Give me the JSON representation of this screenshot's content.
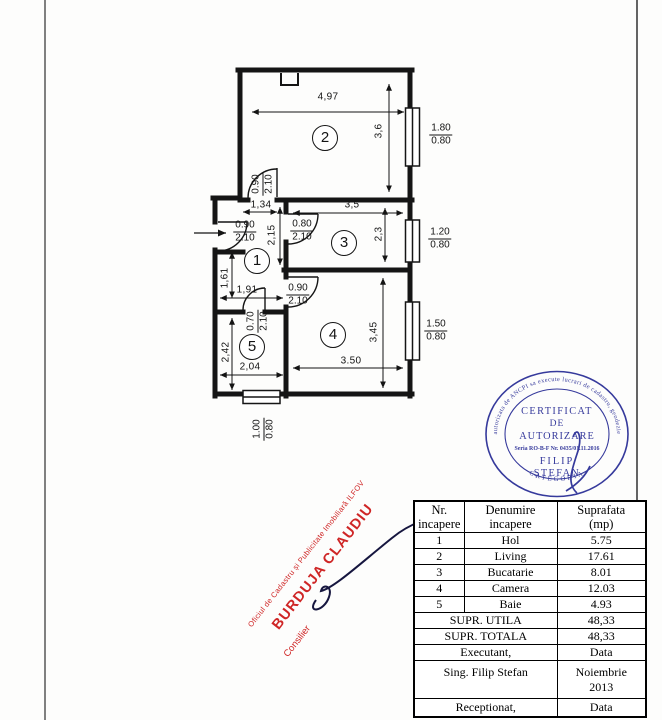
{
  "floorplan": {
    "rooms": {
      "r1": "1",
      "r2": "2",
      "r3": "3",
      "r4": "4",
      "r5": "5"
    },
    "dims": {
      "living_w": "4,97",
      "living_h": "3,6",
      "kitchen_w": "3,5",
      "kitchen_h": "2,3",
      "hall_door_w": "1,34",
      "hall_h1": "2,15",
      "hall_h2": "1,61",
      "hall_w": "1,91",
      "bath_h": "2,42",
      "bath_w": "2,04",
      "camera_h": "3,45",
      "camera_w": "3.50"
    },
    "openings": {
      "door_living": {
        "top": "0.90",
        "bottom": "2.10"
      },
      "door_entry": {
        "top": "0.90",
        "bottom": "2.10"
      },
      "door_kitchen": {
        "top": "0.80",
        "bottom": "2.10"
      },
      "door_camera": {
        "top": "0.90",
        "bottom": "2.10"
      },
      "door_bath": {
        "top": "0.70",
        "bottom": "2.10"
      },
      "win_living": {
        "top": "1.80",
        "bottom": "0.80"
      },
      "win_kitchen": {
        "top": "1.20",
        "bottom": "0.80"
      },
      "win_camera": {
        "top": "1.50",
        "bottom": "0.80"
      },
      "win_bath": {
        "top": "1.00",
        "bottom": "0.80"
      }
    }
  },
  "stamp_round": {
    "color": "#363a9c",
    "arc_top": "autorizata de ANCPI sa execute lucrari de cadastru, geodezie",
    "arc_bottom": "CATEGORIA",
    "line1": "CERTIFICAT",
    "line2": "DE",
    "line3": "AUTORIZARE",
    "serial": "Seria RO-B-F Nr. 0435/01.11.2016",
    "name1": "FILIP",
    "name2": "ȘTEFAN"
  },
  "stamp_red": {
    "color": "#cf2626",
    "line1": "Oficiul de Cadastru și Publicitate Imobiliară ILFOV",
    "line2": "BURDUJA CLAUDIU",
    "line3": "Consilier"
  },
  "table": {
    "headers": {
      "nr": "Nr.\nincapere",
      "name": "Denumire\nincapere",
      "area": "Suprafata\n(mp)"
    },
    "rows": [
      {
        "nr": "1",
        "name": "Hol",
        "area": "5.75"
      },
      {
        "nr": "2",
        "name": "Living",
        "area": "17.61"
      },
      {
        "nr": "3",
        "name": "Bucatarie",
        "area": "8.01"
      },
      {
        "nr": "4",
        "name": "Camera",
        "area": "12.03"
      },
      {
        "nr": "5",
        "name": "Baie",
        "area": "4.93"
      }
    ],
    "supr_utila_label": "SUPR. UTILA",
    "supr_utila": "48,33",
    "supr_totala_label": "SUPR. TOTALA",
    "supr_totala": "48,33",
    "executant_label": "Executant,",
    "data_label": "Data",
    "executant_name": "Sing. Filip  Stefan",
    "date": "Noiembrie\n2013",
    "receptionat_label": "Receptionat,",
    "data_label2": "Data"
  }
}
